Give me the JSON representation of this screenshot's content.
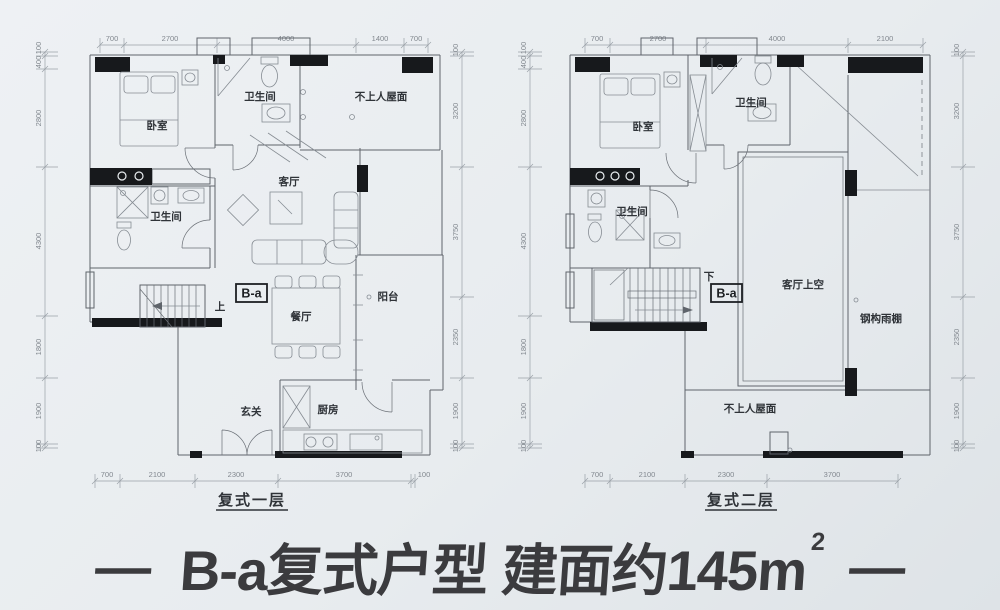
{
  "colors": {
    "background": "#e9edf0",
    "wall_fill": "#17191c",
    "line": "#5f646b",
    "dim_text": "#82888f",
    "label_text": "#2f3338",
    "title_text": "#3b3b3e"
  },
  "title": {
    "left_dash": "—",
    "text": "B-a复式户型 建面约145m",
    "sup_exponent": "2",
    "right_dash": "—"
  },
  "floor1": {
    "caption": "复式一层",
    "dims": {
      "top": [
        "700",
        "2700",
        "4000",
        "1400",
        "700"
      ],
      "bottom": [
        "700",
        "2100",
        "2300",
        "3700",
        "100"
      ],
      "left": [
        "100",
        "400",
        "2800",
        "4300",
        "1800",
        "1900",
        "100"
      ],
      "right": [
        "100",
        "3200",
        "3750",
        "2350",
        "1900",
        "100"
      ]
    },
    "labels": {
      "bedroom": "卧室",
      "bath_top": "卫生间",
      "roof": "不上人屋面",
      "living": "客厅",
      "bath_mid": "卫生间",
      "up": "上",
      "section_marker": "B-a",
      "dining": "餐厅",
      "balcony": "阳台",
      "foyer": "玄关",
      "kitchen": "厨房"
    }
  },
  "floor2": {
    "caption": "复式二层",
    "dims": {
      "top": [
        "700",
        "2700",
        "4000",
        "2100"
      ],
      "bottom": [
        "700",
        "2100",
        "2300",
        "3700"
      ],
      "left": [
        "100",
        "400",
        "2800",
        "4300",
        "1800",
        "1900",
        "100"
      ],
      "right": [
        "100",
        "3200",
        "3750",
        "2350",
        "1900",
        "100"
      ]
    },
    "labels": {
      "bedroom": "卧室",
      "bath_top": "卫生间",
      "bath_mid": "卫生间",
      "down": "下",
      "section_marker": "B-a",
      "living_void": "客厅上空",
      "canopy": "钢构雨棚",
      "roof": "不上人屋面"
    }
  }
}
